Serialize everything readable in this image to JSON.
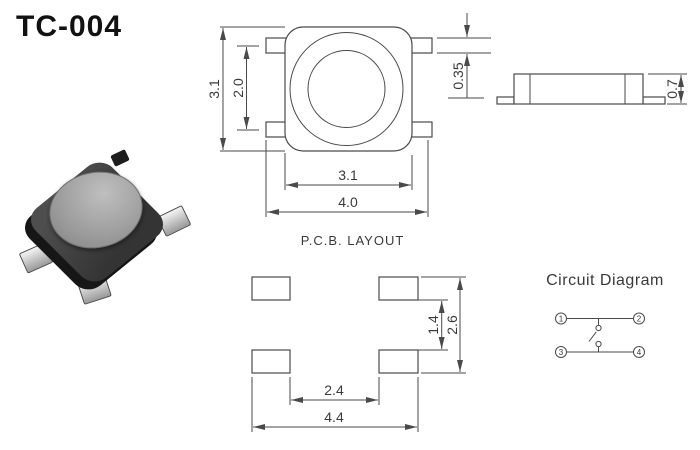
{
  "title": "TC-004",
  "colors": {
    "line": "#4a4a4a",
    "text": "#3a3a3a",
    "switch_body": "#3c3c3c",
    "switch_button": "#a5a5a5"
  },
  "top_view": {
    "dim_body_height": "3.1",
    "dim_lead_pitch": "2.0",
    "dim_body_width": "3.1",
    "dim_total_width": "4.0",
    "dim_lead_thickness": "0.35"
  },
  "side_view": {
    "dim_height": "0.7"
  },
  "pcb_layout": {
    "title": "P.C.B. LAYOUT",
    "dim_pad_inner_vertical": "1.4",
    "dim_pad_outer_vertical": "2.6",
    "dim_pad_inner_horizontal": "2.4",
    "dim_pad_outer_horizontal": "4.4"
  },
  "circuit": {
    "title": "Circuit Diagram",
    "terminals": [
      "1",
      "2",
      "3",
      "4"
    ]
  }
}
